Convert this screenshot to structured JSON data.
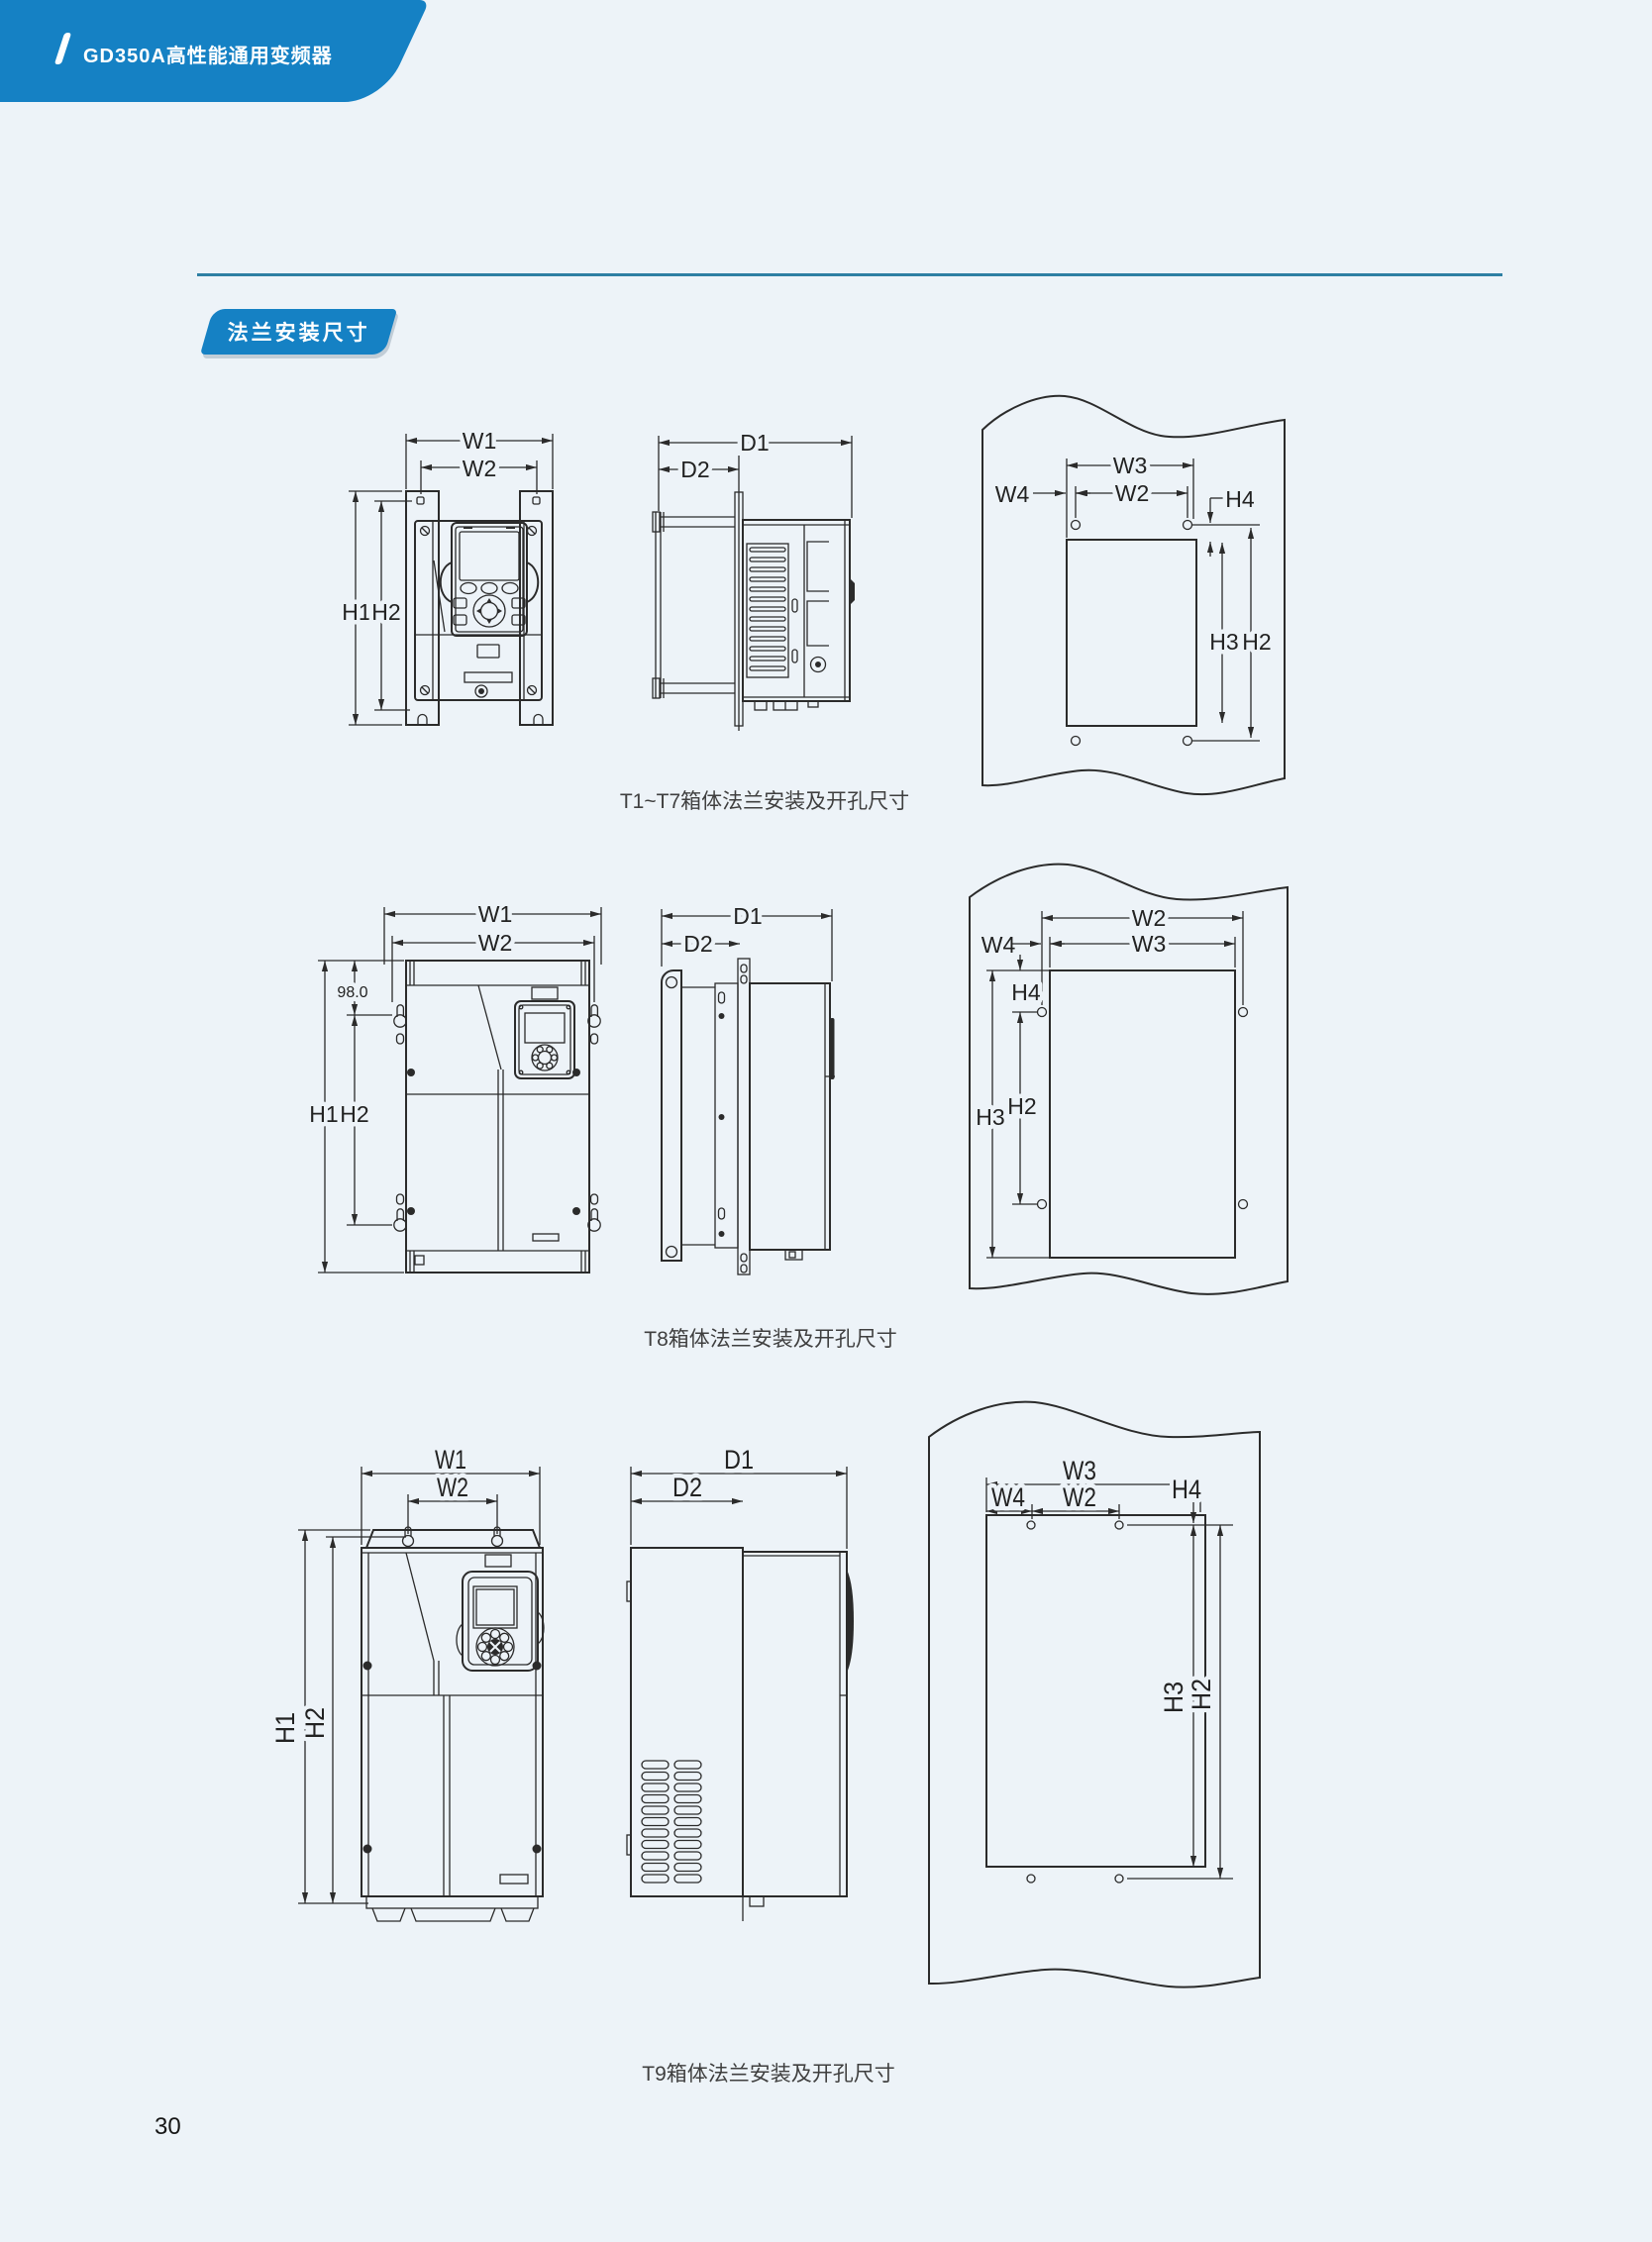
{
  "header": {
    "brand_slash": "/",
    "title": "GD350A高性能通用变频器"
  },
  "section_tag": "法兰安装尺寸",
  "page_number": "30",
  "figures": {
    "t1t7": {
      "caption": "T1~T7箱体法兰安装及开孔尺寸",
      "front": {
        "w1": "W1",
        "w2": "W2",
        "h1": "H1",
        "h2": "H2"
      },
      "side": {
        "d1": "D1",
        "d2": "D2"
      },
      "panel": {
        "w3": "W3",
        "w2": "W2",
        "w4": "W4",
        "h4": "H4",
        "h3": "H3",
        "h2": "H2"
      }
    },
    "t8": {
      "caption": "T8箱体法兰安装及开孔尺寸",
      "front": {
        "w1": "W1",
        "w2": "W2",
        "offset": "98.0",
        "h1": "H1",
        "h2": "H2"
      },
      "side": {
        "d1": "D1",
        "d2": "D2"
      },
      "panel": {
        "w2": "W2",
        "w3": "W3",
        "w4": "W4",
        "h4": "H4",
        "h3": "H3",
        "h2": "H2"
      }
    },
    "t9": {
      "caption": "T9箱体法兰安装及开孔尺寸",
      "front": {
        "w1": "W1",
        "w2": "W2",
        "h1": "H1",
        "h2": "H2"
      },
      "side": {
        "d1": "D1",
        "d2": "D2"
      },
      "panel": {
        "w3": "W3",
        "w4": "W4",
        "w2": "W2",
        "h4": "H4",
        "h3": "H3",
        "h2": "H2"
      }
    }
  },
  "colors": {
    "brand_blue": "#1581c4",
    "rule_teal": "#2e7fa3",
    "page_bg": "#edf3f8",
    "ink": "#2b2b2b",
    "caption_gray": "#3f3f3f"
  }
}
